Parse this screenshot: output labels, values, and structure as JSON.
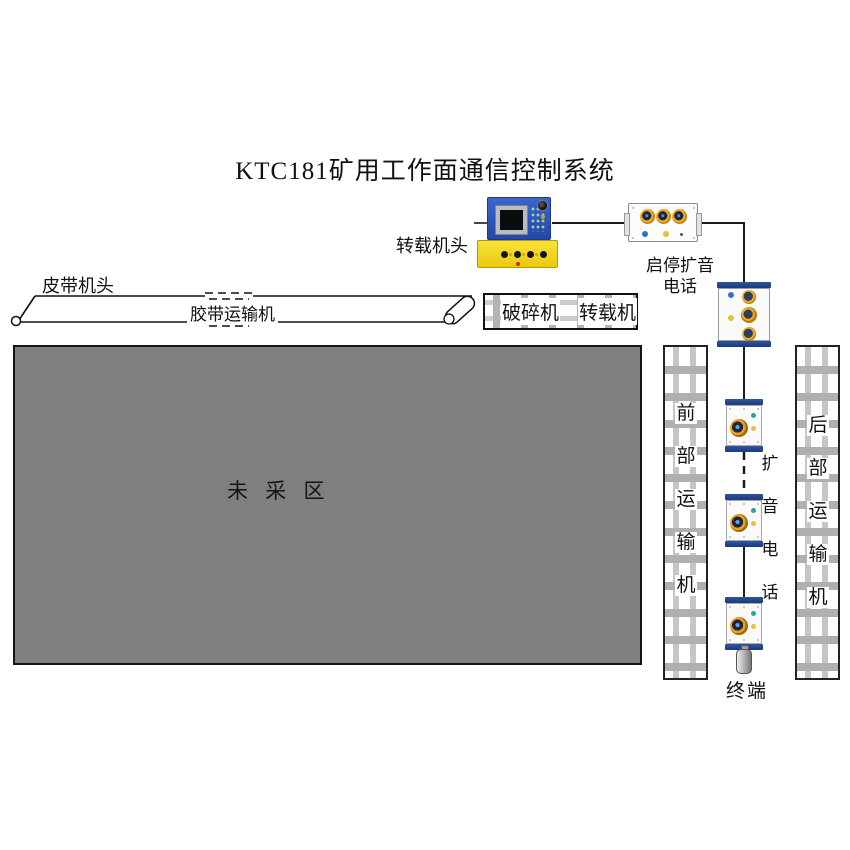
{
  "title": "KTC181矿用工作面通信控制系统",
  "control_station": {
    "label": "转载机头"
  },
  "start_stop_phone": {
    "label": "启停扩音电话"
  },
  "belt": {
    "head_label": "皮带机头",
    "body_label": "胶带运输机"
  },
  "equipment_row": {
    "crusher": "破碎机",
    "transfer": "转载机"
  },
  "mining_area": {
    "label": "未 采 区"
  },
  "front_conveyor": {
    "label": "前部运输机"
  },
  "rear_conveyor": {
    "label": "后部运输机"
  },
  "loudspeaker_phones": {
    "label": "扩音电话"
  },
  "terminal": {
    "label": "终端"
  },
  "colors": {
    "device_yellow": "#F2CF1A",
    "panel_blue": "#2B59C3",
    "speaker_ring_orange": "#EF9F1B",
    "speaker_center_navy": "#1A2742",
    "cap_blue": "#23468E",
    "indicator_teal": "#29A39B",
    "indicator_yellow": "#E6C32E",
    "indicator_blue": "#2F6FD6",
    "mining_area_gray": "#7F7F7F",
    "line_black": "#1A1A1A"
  }
}
